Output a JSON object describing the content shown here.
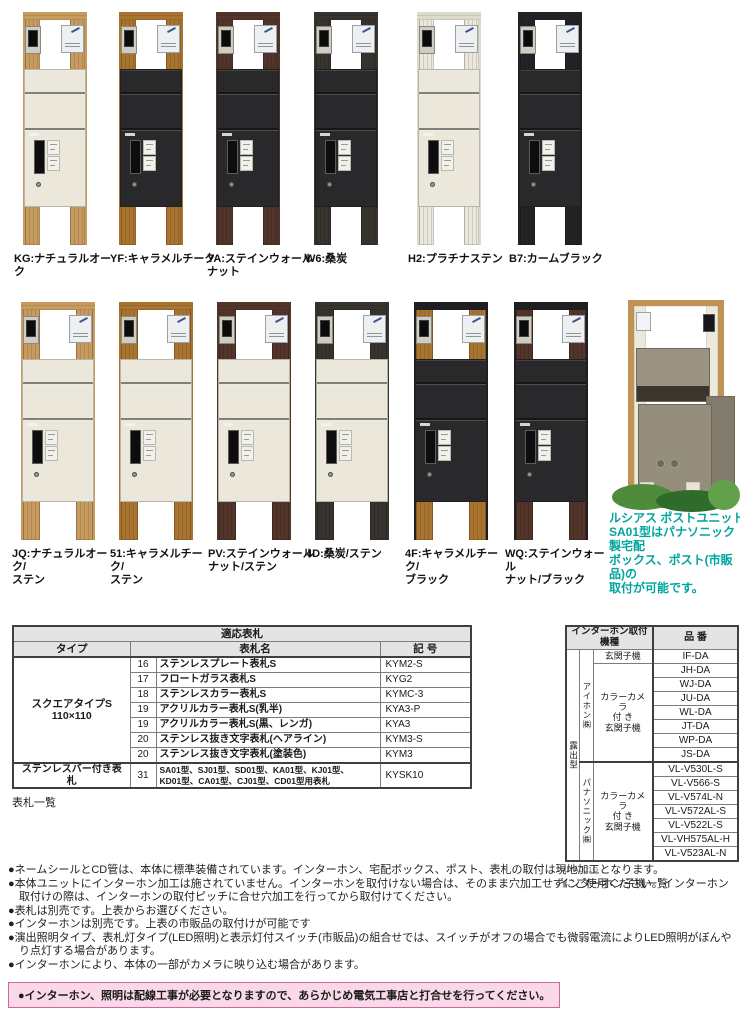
{
  "colors": {
    "accent_teal": "#00a59d",
    "warning_bg": "#f9d9e8",
    "warning_border": "#d0679f",
    "table_header_bg": "#e4e4e4"
  },
  "products": {
    "row1": [
      {
        "code": "KG",
        "label": "KG:ナチュラルオーク",
        "frame": "#c79b5e",
        "edge": "#c79b5e",
        "box": "#ebe7da"
      },
      {
        "code": "YF",
        "label": "YF:キャラメルチーク",
        "frame": "#a9742f",
        "edge": "#a9742f",
        "box": "#29292b"
      },
      {
        "code": "YA",
        "label": "YA:ステインウォール\nナット",
        "frame": "#53342b",
        "edge": "#53342b",
        "box": "#29292b"
      },
      {
        "code": "W6",
        "label": "W6:桑炭",
        "frame": "#37332e",
        "edge": "#37332e",
        "box": "#29292b"
      },
      {
        "code": "H2",
        "label": "H2:プラチナステン",
        "frame": "#eae7dc",
        "edge": "#dedacd",
        "box": "#ebe7da"
      },
      {
        "code": "B7",
        "label": "B7:カームブラック",
        "frame": "#232325",
        "edge": "#232325",
        "box": "#29292b"
      }
    ],
    "row2": [
      {
        "code": "JQ",
        "label": "JQ:ナチュラルオーク/\nステン",
        "frame": "#c79b5e",
        "edge": "#c79b5e",
        "box": "#ebe7da"
      },
      {
        "code": "51",
        "label": "51:キャラメルチーク/\nステン",
        "frame": "#a9742f",
        "edge": "#a9742f",
        "box": "#ebe7da"
      },
      {
        "code": "PV",
        "label": "PV:ステインウォール\nナット/ステン",
        "frame": "#53342b",
        "edge": "#53342b",
        "box": "#ebe7da"
      },
      {
        "code": "4D",
        "label": "4D:桑炭/ステン",
        "frame": "#37332e",
        "edge": "#37332e",
        "box": "#ebe7da"
      },
      {
        "code": "4F",
        "label": "4F:キャラメルチーク/\nブラック",
        "frame": "#a9742f",
        "edge": "#1f1f22",
        "box": "#29292b"
      },
      {
        "code": "WQ",
        "label": "WQ:ステインウォール\nナット/ブラック",
        "frame": "#53342b",
        "edge": "#1f1f22",
        "box": "#29292b"
      }
    ]
  },
  "photo_caption": "ルシアス ポストユニット\nSA01型はパナソニック製宅配\nボックス、ポスト(市販品)の\n取付が可能です。",
  "nameplate_table": {
    "title": "適応表札",
    "col_type": "タイプ",
    "col_name": "表札名",
    "col_code": "記 号",
    "groups": [
      {
        "type": "スクエアタイプS\n110×110",
        "rows": [
          {
            "no": "16",
            "name": "ステンレスプレート表札S",
            "code": "KYM2-S"
          },
          {
            "no": "17",
            "name": "フロートガラス表札S",
            "code": "KYG2"
          },
          {
            "no": "18",
            "name": "ステンレスカラー表札S",
            "code": "KYMC-3"
          },
          {
            "no": "19",
            "name": "アクリルカラー表札S(乳半)",
            "code": "KYA3-P"
          },
          {
            "no": "19",
            "name": "アクリルカラー表札S(黒、レンガ)",
            "code": "KYA3"
          },
          {
            "no": "20",
            "name": "ステンレス抜き文字表札(ヘアライン)",
            "code": "KYM3-S"
          },
          {
            "no": "20",
            "name": "ステンレス抜き文字表札(塗装色)",
            "code": "KYM3"
          }
        ]
      },
      {
        "type": "ステンレスバー付き表札",
        "rows": [
          {
            "no": "31",
            "name": "SA01型、SJ01型、SD01型、KA01型、KJ01型、\nKD01型、CA01型、CJ01型、CD01型用表札",
            "code": "KYSK10"
          }
        ]
      }
    ],
    "caption": "表札一覧"
  },
  "intercom_table": {
    "title": "インターホン取付機種",
    "col_part": "品 番",
    "mount": "露出型",
    "makers": [
      {
        "name": "アイホン㈱",
        "groups": [
          {
            "label": "玄関子機",
            "parts": [
              "IF-DA"
            ]
          },
          {
            "label": "カラーカメラ\n付 き\n玄関子機",
            "parts": [
              "JH-DA",
              "WJ-DA",
              "JU-DA",
              "WL-DA",
              "JT-DA",
              "WP-DA",
              "JS-DA"
            ]
          }
        ]
      },
      {
        "name": "パナソニック㈱",
        "groups": [
          {
            "label": "カラーカメラ\n付 き\n玄関子機",
            "parts": [
              "VL-V530L-S",
              "VL-V566-S",
              "VL-V574L-N",
              "VL-V572AL-S",
              "VL-V522L-S",
              "VL-VH575AL-H",
              "VL-V523AL-N"
            ]
          }
        ]
      }
    ],
    "code": "XUYA001G",
    "caption": "インターホン子機一覧"
  },
  "notes": [
    "●ネームシールとCD管は、本体に標準装備されています。インターホン、宅配ボックス、ポスト、表札の取付は現地加工となります。",
    "●本体ユニットにインターホン加工は施されていません。インターホンを取付けない場合は、そのまま穴加工せずにご使用ください。インターホン取付けの際は、インターホンの取付ピッチに合せ穴加工を行ってから取付けてください。",
    "●表札は別売です。上表からお選びください。",
    "●インターホンは別売です。上表の市販品の取付けが可能です",
    "●演出照明タイプ、表札灯タイプ(LED照明)と表示灯付スイッチ(市販品)の組合せでは、スイッチがオフの場合でも微弱電流によりLED照明がぼんやり点灯する場合があります。",
    "●インターホンにより、本体の一部がカメラに映り込む場合があります。"
  ],
  "warning": "●インターホン、照明は配線工事が必要となりますので、あらかじめ電気工事店と打合せを行ってください。"
}
